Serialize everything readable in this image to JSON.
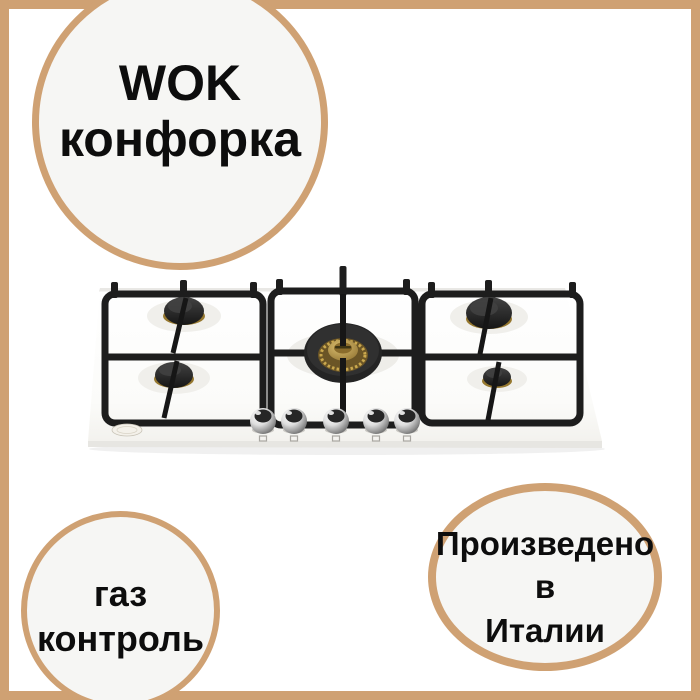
{
  "badges": {
    "wok": {
      "line1": "WOK",
      "line2": "конфорка"
    },
    "gas_control": {
      "line1": "газ",
      "line2": "контроль"
    },
    "made_in_italy": {
      "line1": "Произведено",
      "line2": "в",
      "line3": "Италии"
    }
  },
  "product_photo": {
    "alt": "Белая газовая варочная панель с пятью конфорками, чугунными решётками, WOK-конфоркой и пятью хромированными ручками"
  },
  "colors": {
    "accent": "#CFA173",
    "badge_fill": "#F6F6F4",
    "text": "#0D0D0D",
    "background": "#FFFFFF"
  }
}
